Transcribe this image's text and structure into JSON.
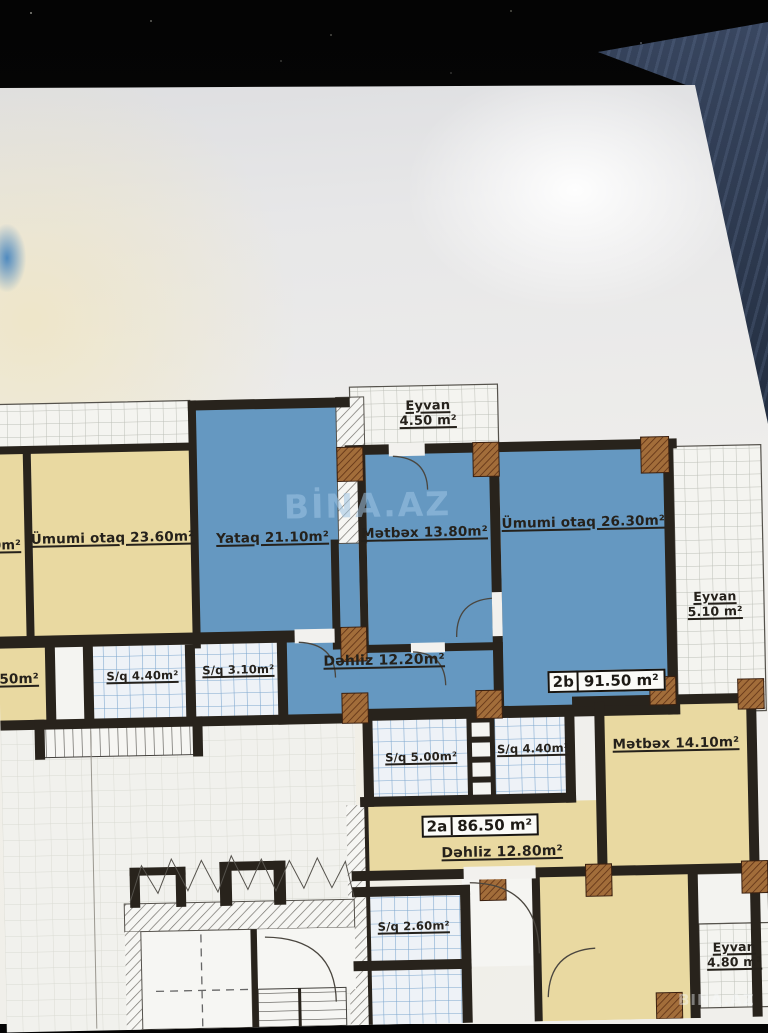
{
  "watermark": {
    "center": "BİNA.AZ",
    "corner": "BINA.AZ"
  },
  "rooms": {
    "eyvan_top": {
      "name": "Eyvan",
      "area": "4.50 m²"
    },
    "umumi_otaq_23": {
      "label": "Ümumi otaq 23.60m²"
    },
    "yataq": {
      "label": "Yataq 21.10m²"
    },
    "metbex_13": {
      "label": "Mətbəx 13.80m²"
    },
    "umumi_otaq_26": {
      "label": "Ümumi otaq 26.30m²"
    },
    "eyvan_right": {
      "name": "Eyvan",
      "area": "5.10 m²"
    },
    "sq_440_a": {
      "label": "S/q 4.40m²"
    },
    "sq_310": {
      "label": "S/q 3.10m²"
    },
    "dehliz_1220": {
      "label": "Dəhliz 12.20m²"
    },
    "sq_500": {
      "label": "S/q 5.00m²"
    },
    "sq_440_b": {
      "label": "S/q 4.40m²"
    },
    "metbex_14": {
      "label": "Mətbəx 14.10m²"
    },
    "dehliz_1280": {
      "label": "Dəhliz 12.80m²"
    },
    "sq_260": {
      "label": "S/q 2.60m²"
    },
    "eyvan_bottom": {
      "name": "Eyvan",
      "area": "4.80 m²"
    },
    "partial_left_top": {
      "label": "0m²"
    },
    "partial_left_mid": {
      "label": ".50m²"
    }
  },
  "apartments": {
    "a2b": {
      "code": "2b",
      "area": "91.50 m²"
    },
    "a2a": {
      "code": "2a",
      "area": "86.50 m²"
    }
  },
  "palette": {
    "room_blue": "#6598c1",
    "room_yellow": "#e9d9a1",
    "wall_black": "#28231c",
    "column_brown": "#a26d3a",
    "paper": "#f0efec"
  }
}
